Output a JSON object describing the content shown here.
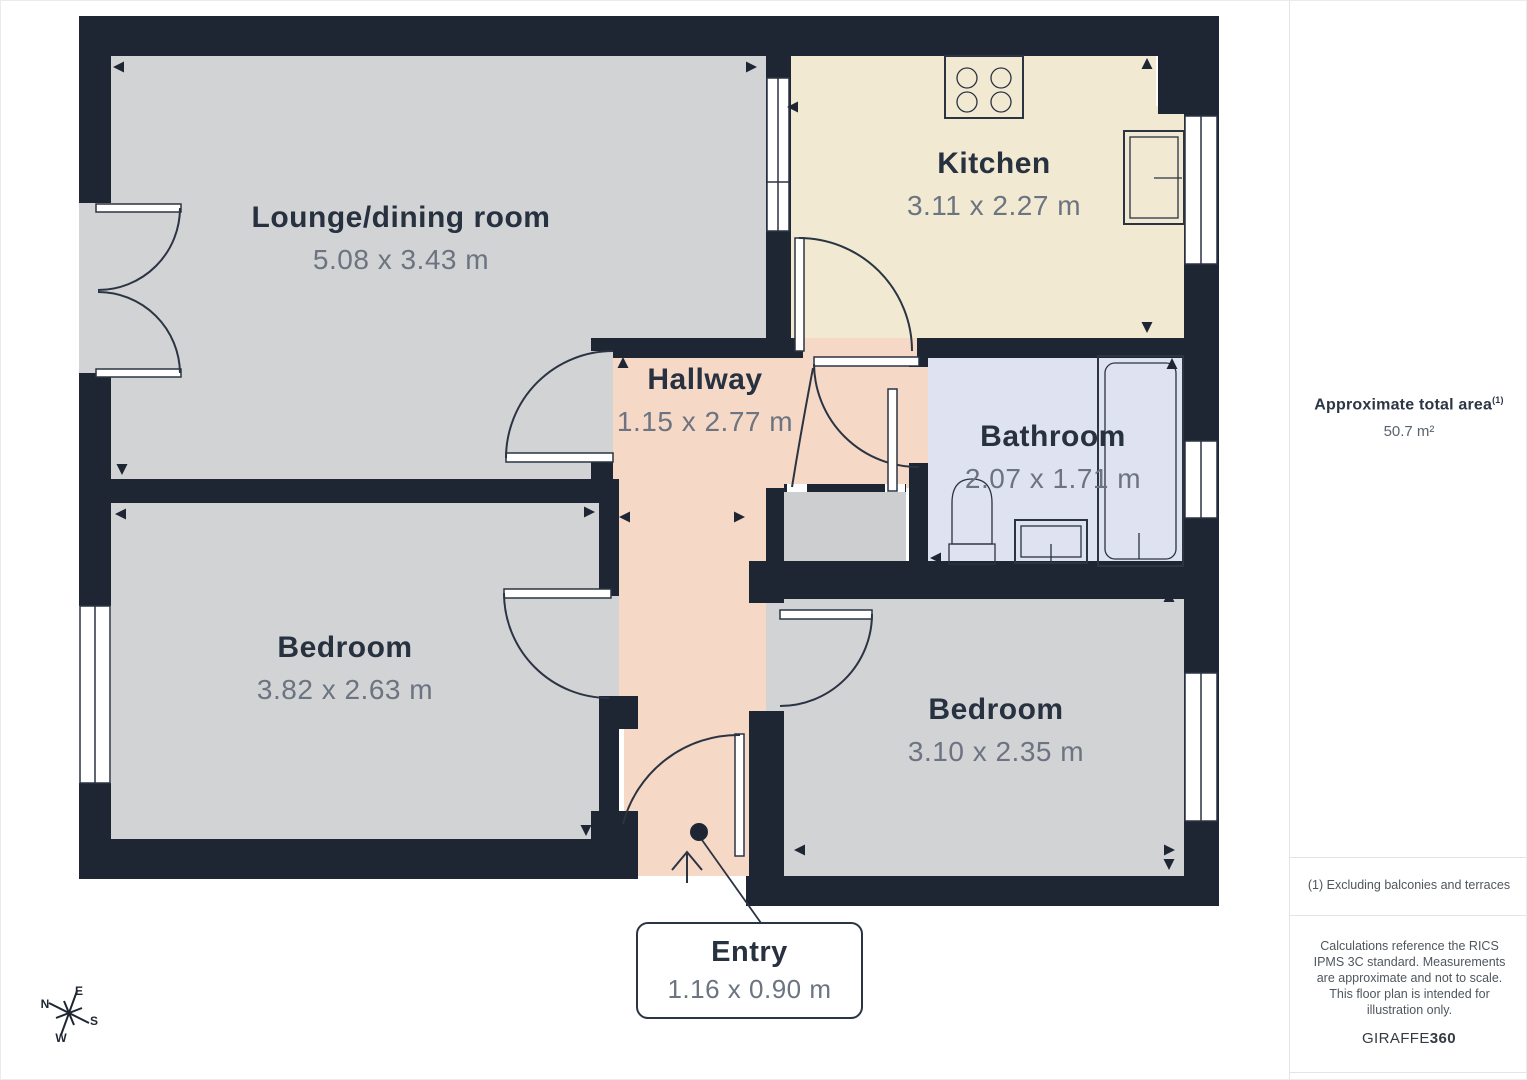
{
  "plan": {
    "rooms": [
      {
        "id": "lounge",
        "name": "Lounge/dining room",
        "dims": "5.08 x 3.43 m",
        "floor_color": "#d2d3d5"
      },
      {
        "id": "kitchen",
        "name": "Kitchen",
        "dims": "3.11 x 2.27 m",
        "floor_color": "#f1e9d2"
      },
      {
        "id": "hallway",
        "name": "Hallway",
        "dims": "1.15 x 2.77 m",
        "floor_color": "#f6d8c6"
      },
      {
        "id": "bathroom",
        "name": "Bathroom",
        "dims": "2.07 x 1.71 m",
        "floor_color": "#dfe3f1"
      },
      {
        "id": "bedroom1",
        "name": "Bedroom",
        "dims": "3.82 x 2.63 m",
        "floor_color": "#d2d3d5"
      },
      {
        "id": "bedroom2",
        "name": "Bedroom",
        "dims": "3.10 x 2.35 m",
        "floor_color": "#d2d3d5"
      }
    ],
    "entry": {
      "name": "Entry",
      "dims": "1.16 x 0.90 m"
    },
    "compass": {
      "n": "N",
      "e": "E",
      "s": "S",
      "w": "W"
    },
    "colors": {
      "wall": "#1e2634",
      "label_dark": "#273140",
      "label_gray": "#6b7480"
    }
  },
  "sidebar": {
    "area_title": "Approximate total area",
    "area_footnote_marker": "(1)",
    "area_value": "50.7 m²",
    "footnote": "(1) Excluding balconies and terraces",
    "disclaimer": "Calculations reference the RICS IPMS 3C standard. Measurements are approximate and not to scale. This floor plan is intended for illustration only.",
    "brand_name": "GIRAFFE",
    "brand_number": "360"
  }
}
